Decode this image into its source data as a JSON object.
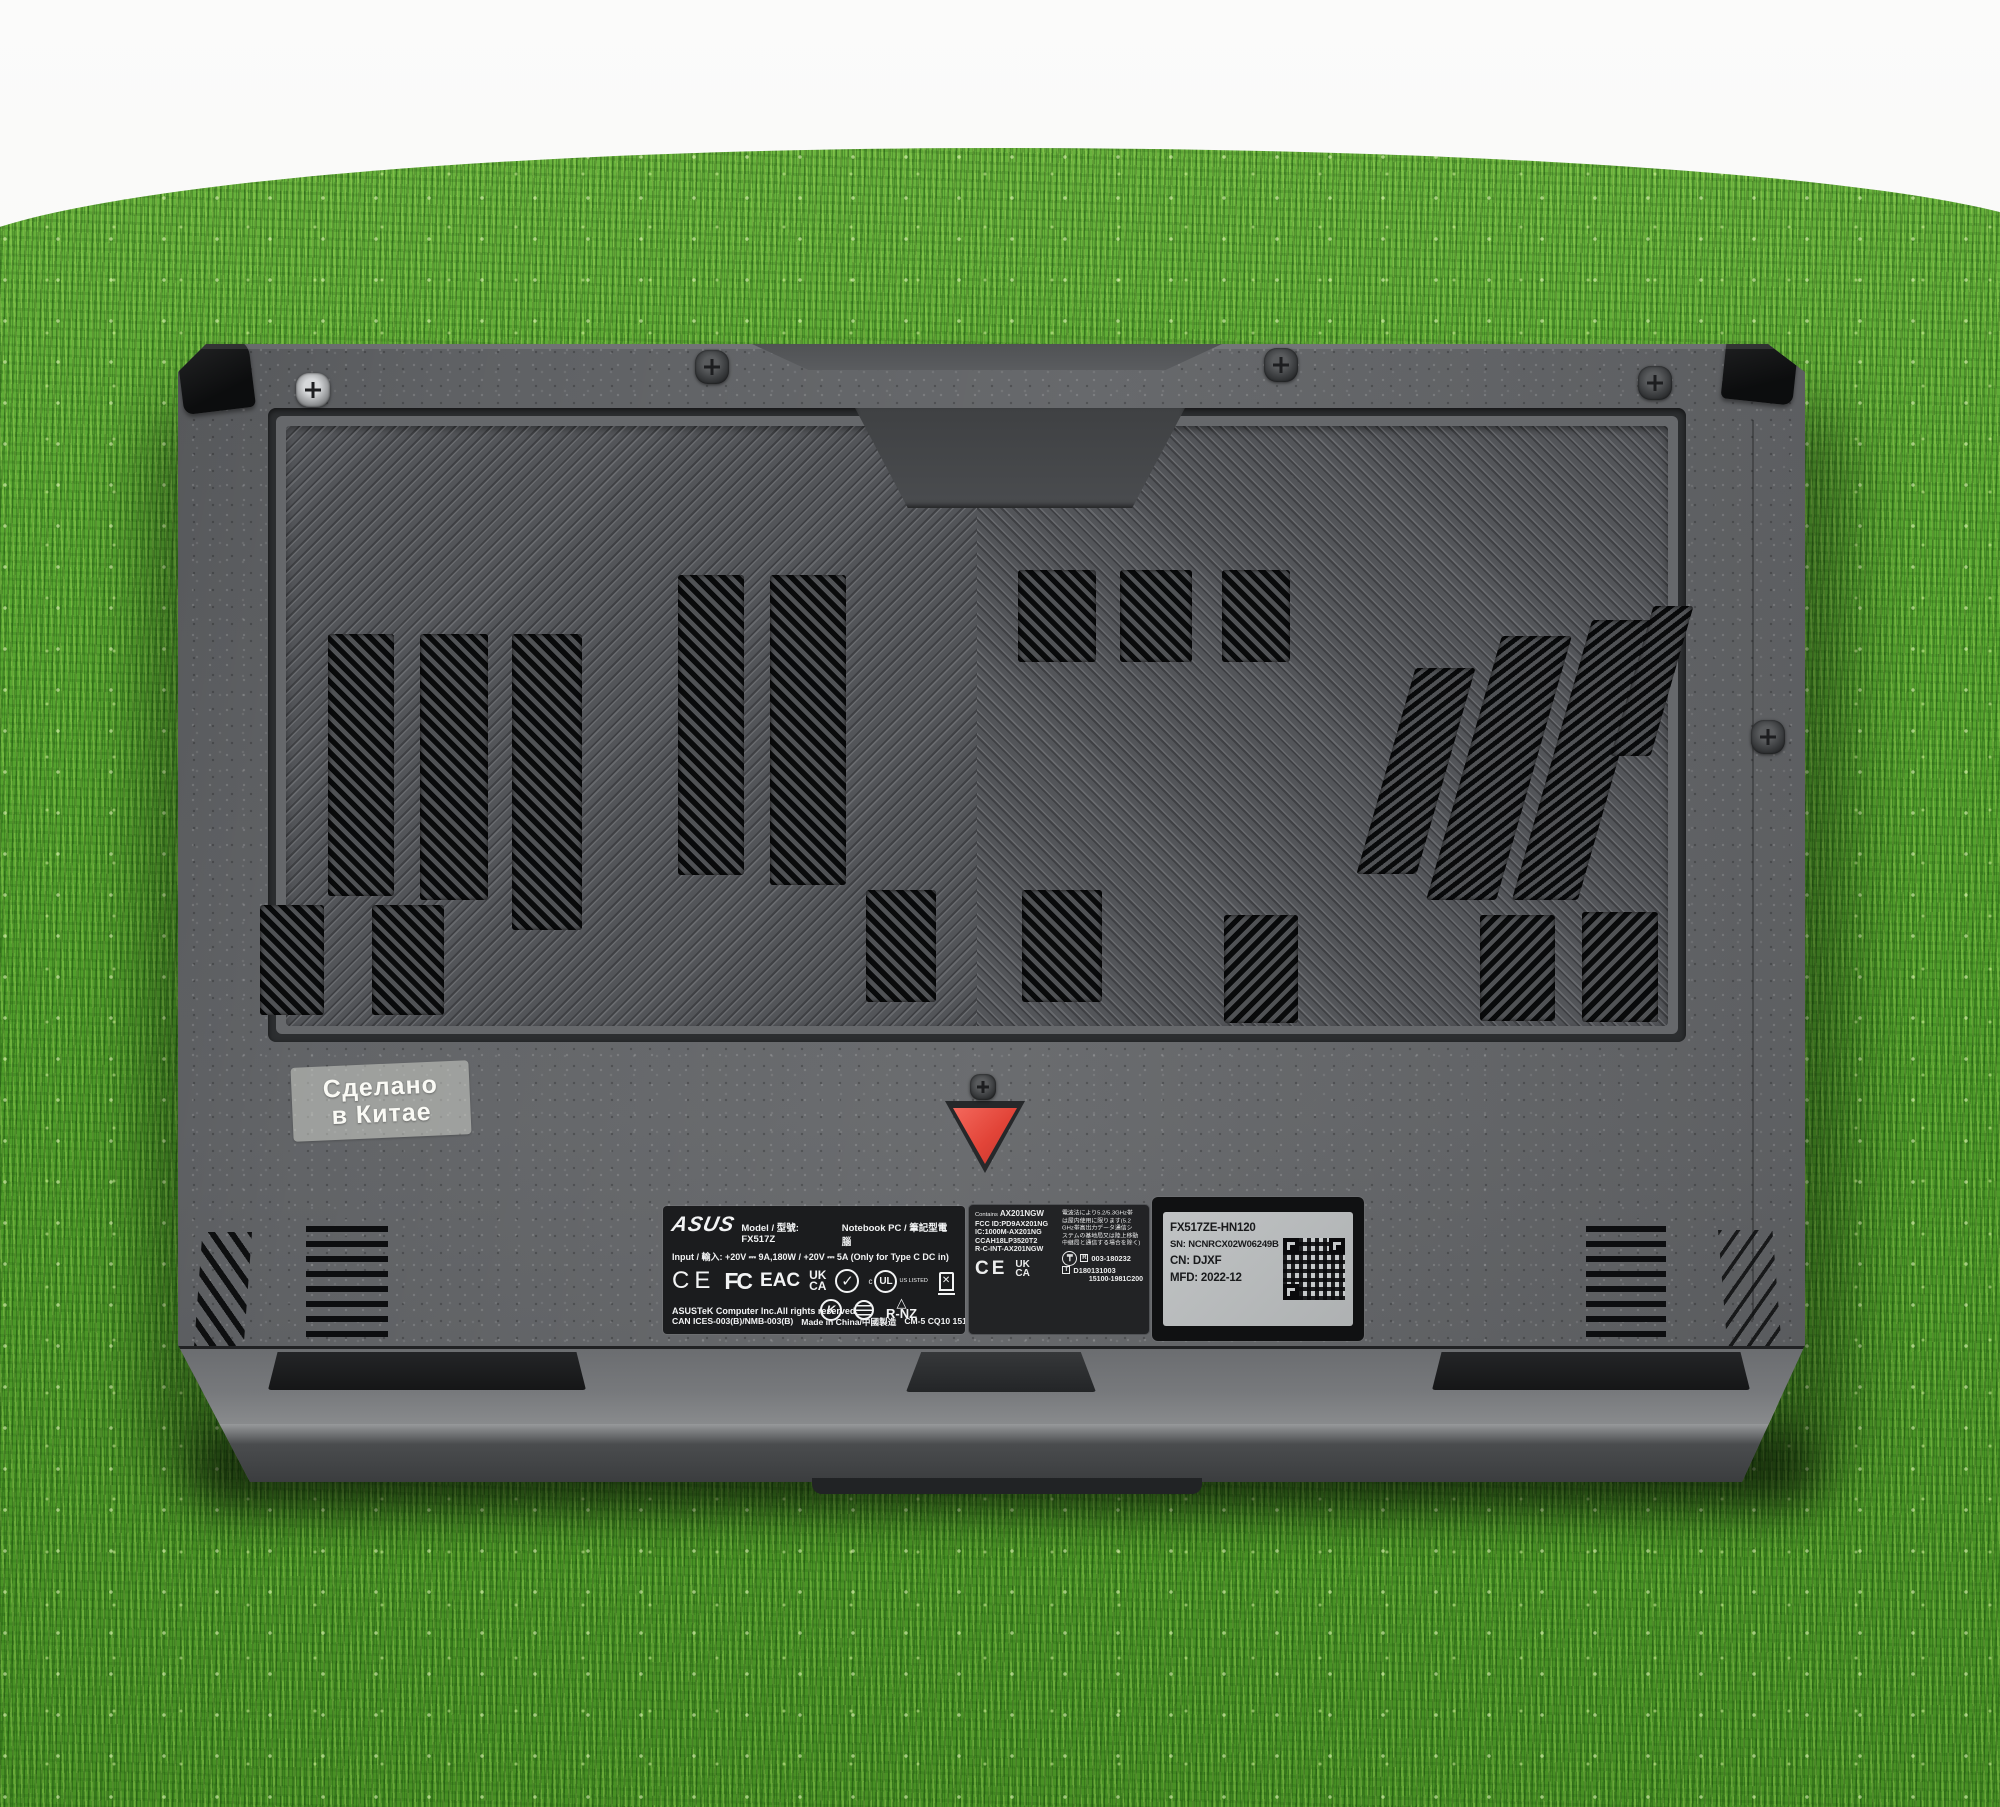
{
  "colors": {
    "grass_green": "#58a82e",
    "body_gray": "#606265",
    "panel_gray": "#55575b",
    "vent_black": "#090a0b",
    "warning_red": "#e24438",
    "label_black": "#1b1c1e",
    "serial_silver": "#b7babc",
    "background_white": "#f7f8f6"
  },
  "sticker": {
    "line1": "Сделано",
    "line2": "в Китае"
  },
  "regulatory_label": {
    "brand": "ASUS",
    "model": "Model / 型號: FX517Z",
    "device_type": "Notebook PC / 筆記型電腦",
    "input": "Input / 輸入: +20V ⎓ 9A,180W / +20V ⎓ 5A (Only for Type C DC in)",
    "marks": {
      "ce": "CE",
      "fcc": "FC",
      "eac": "EAC",
      "ukca_top": "UK",
      "ukca_bot": "CA",
      "check": "✓",
      "ul_prefix": "c",
      "ul": "UL",
      "ul_listed": "US LISTED",
      "kc": "K",
      "rohs": "RoHS",
      "rnz_triangle": "△",
      "rnz": "R-NZ"
    },
    "copyright": "ASUSTeK Computer Inc.All rights reserved.",
    "ices": "CAN ICES-003(B)/NMB-003(B)",
    "made_in": "Made in China/中國製造",
    "code": "CM-5 CQ10 15105-0932P000"
  },
  "wireless_label": {
    "contains_prefix": "Contains",
    "contains": "AX201NGW",
    "fcc_id": "FCC ID:PD9AX201NG",
    "ic": "IC:1000M-AX201NG",
    "ncc": "CCAH18LP3520T2",
    "rc": "R-C-INT-AX201NGW",
    "ce": "CE",
    "ukca_top": "UK",
    "ukca_bot": "CA",
    "jp_line1": "電波法により5.2/5.3GHz帯",
    "jp_line2": "は屋内使用に限ります(5.2",
    "jp_line3": "GHz帯高出力データ通信シ",
    "jp_line4": "ステムの基地局又は陸上移動",
    "jp_line5": "中継局と通信する場合を除く)",
    "giteki": "₸",
    "r_prefix": "R",
    "r_number": "003-180232",
    "t_prefix": "T",
    "t_number": "D180131003",
    "code": "15100-1981C200"
  },
  "serial_label": {
    "model": "FX517ZE-HN120",
    "sn": "SN: NCNRCX02W06249B",
    "cn": "CN: DJXF",
    "mfd": "MFD: 2022-12"
  }
}
